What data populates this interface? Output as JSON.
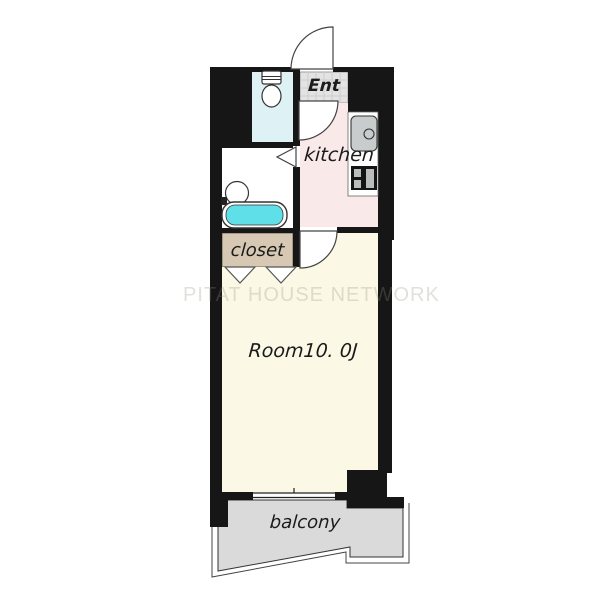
{
  "floorplan": {
    "watermark": "PITAT HOUSE NETWORK",
    "rooms": {
      "entrance": {
        "label": "Ent"
      },
      "kitchen": {
        "label": "kitchen"
      },
      "closet": {
        "label": "closet"
      },
      "main_room": {
        "label": "Room10. 0J"
      },
      "balcony": {
        "label": "balcony"
      }
    },
    "fixtures": [
      "toilet",
      "bathtub",
      "wash-basin",
      "kitchen-sink",
      "stove",
      "entrance-door-swing",
      "kitchen-door-swing",
      "room-door-swing",
      "bathroom-folding-door",
      "closet-folding-door",
      "balcony-window"
    ],
    "colors": {
      "wall": "#161616",
      "toilet_room_floor": "#def1f4",
      "entrance_floor": "#e3e3e3",
      "kitchen_floor": "#f9e9e9",
      "washroom_floor": "#ffffff",
      "closet_floor": "#d6c8b2",
      "main_room_floor": "#fbf8e5",
      "balcony_floor": "#dadada",
      "bathtub_water": "#5fe0e8",
      "watermark_text": "#94907c"
    }
  }
}
